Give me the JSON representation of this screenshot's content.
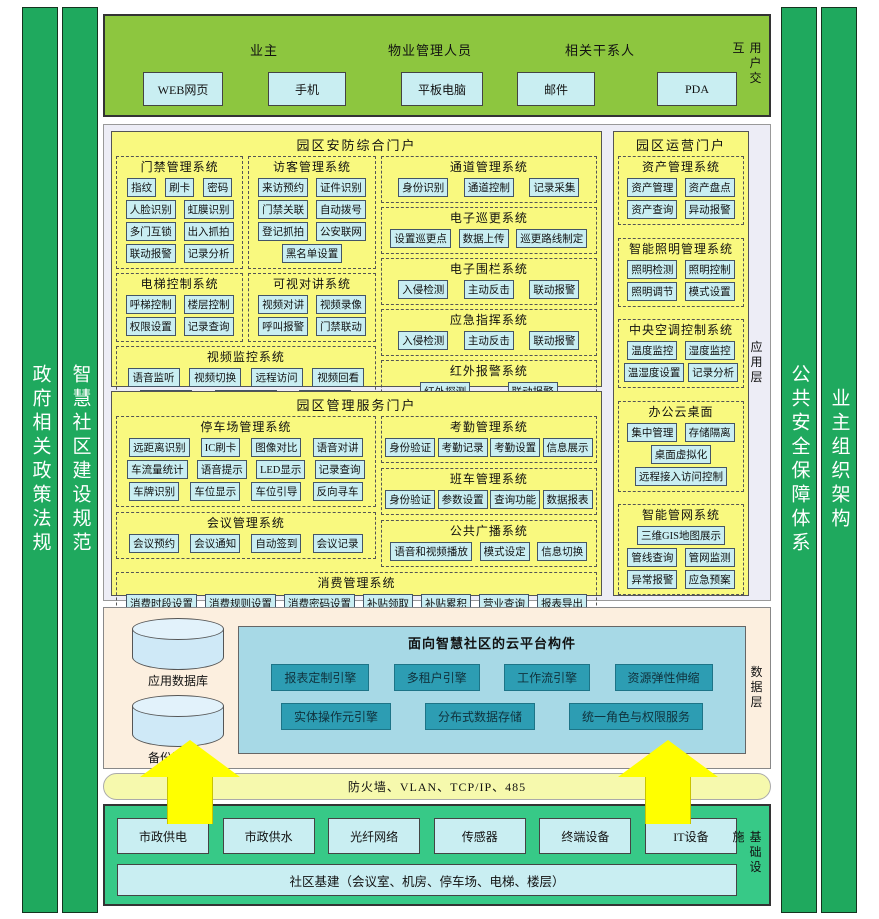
{
  "side_bars": {
    "left": [
      "政府相关政策法规",
      "智慧社区建设规范"
    ],
    "right": [
      "公共安全保障体系",
      "业主组织架构"
    ]
  },
  "user_layer": {
    "label": "用户交互",
    "groups": [
      "业主",
      "物业管理人员",
      "相关干系人"
    ],
    "devices": [
      "WEB网页",
      "手机",
      "平板电脑",
      "邮件",
      "PDA"
    ]
  },
  "application_layer": {
    "label": "应用层",
    "security_portal": {
      "title": "园区安防综合门户",
      "systems": [
        {
          "title": "门禁管理系统",
          "rows": [
            [
              "指纹",
              "刷卡",
              "密码"
            ],
            [
              "人脸识别",
              "虹膜识别"
            ],
            [
              "多门互锁",
              "出入抓拍"
            ],
            [
              "联动报警",
              "记录分析"
            ]
          ]
        },
        {
          "title": "访客管理系统",
          "rows": [
            [
              "来访预约",
              "证件识别"
            ],
            [
              "门禁关联",
              "自动拨号"
            ],
            [
              "登记抓拍",
              "公安联网"
            ],
            [
              "黑名单设置"
            ]
          ]
        },
        {
          "title": "电梯控制系统",
          "rows": [
            [
              "呼梯控制",
              "楼层控制"
            ],
            [
              "权限设置",
              "记录查询"
            ]
          ]
        },
        {
          "title": "可视对讲系统",
          "rows": [
            [
              "视频对讲",
              "视频录像"
            ],
            [
              "呼叫报警",
              "门禁联动"
            ]
          ]
        },
        {
          "title": "视频监控系统",
          "rows": [
            [
              "语音监听",
              "视频切换",
              "远程访问",
              "视频回看"
            ],
            [
              "本地录像",
              "电视墙显示",
              "联动报警"
            ]
          ]
        },
        {
          "title": "通道管理系统",
          "rows": [
            [
              "身份识别",
              "通道控制",
              "记录采集"
            ]
          ]
        },
        {
          "title": "电子巡更系统",
          "rows": [
            [
              "设置巡更点",
              "数据上传",
              "巡更路线制定"
            ]
          ]
        },
        {
          "title": "电子围栏系统",
          "rows": [
            [
              "入侵检测",
              "主动反击",
              "联动报警"
            ]
          ]
        },
        {
          "title": "应急指挥系统",
          "rows": [
            [
              "入侵检测",
              "主动反击",
              "联动报警"
            ]
          ]
        },
        {
          "title": "红外报警系统",
          "rows": [
            [
              "红外探测",
              "联动报警"
            ]
          ]
        }
      ]
    },
    "service_portal": {
      "title": "园区管理服务门户",
      "systems": [
        {
          "title": "停车场管理系统",
          "rows": [
            [
              "远距离识别",
              "IC刷卡",
              "图像对比",
              "语音对讲"
            ],
            [
              "车流量统计",
              "语音提示",
              "LED显示",
              "记录查询"
            ],
            [
              "车牌识别",
              "车位显示",
              "车位引导",
              "反向寻车"
            ]
          ]
        },
        {
          "title": "考勤管理系统",
          "rows": [
            [
              "身份验证",
              "考勤记录",
              "考勤设置",
              "信息展示"
            ]
          ]
        },
        {
          "title": "班车管理系统",
          "rows": [
            [
              "身份验证",
              "参数设置",
              "查询功能",
              "数据报表"
            ]
          ]
        },
        {
          "title": "会议管理系统",
          "rows": [
            [
              "会议预约",
              "会议通知",
              "自动签到",
              "会议记录"
            ]
          ]
        },
        {
          "title": "公共广播系统",
          "rows": [
            [
              "语音和视频播放",
              "模式设定",
              "信息切换"
            ]
          ]
        },
        {
          "title": "消费管理系统",
          "rows": [
            [
              "消费时段设置",
              "消费规则设置",
              "消费密码设置",
              "补贴领取",
              "补贴累积",
              "营业查询",
              "报表导出"
            ],
            [
              "卡发行",
              "卡注销",
              "卡充值",
              "卡挂失",
              "卡解挂",
              "卡权限修改",
              "黑名单设置"
            ]
          ]
        }
      ]
    },
    "operation_portal": {
      "title": "园区运营门户",
      "systems": [
        {
          "title": "资产管理系统",
          "rows": [
            [
              "资产管理",
              "资产盘点"
            ],
            [
              "资产查询",
              "异动报警"
            ]
          ]
        },
        {
          "title": "智能照明管理系统",
          "rows": [
            [
              "照明检测",
              "照明控制"
            ],
            [
              "照明调节",
              "模式设置"
            ]
          ]
        },
        {
          "title": "中央空调控制系统",
          "rows": [
            [
              "温度监控",
              "湿度监控"
            ],
            [
              "温湿度设置",
              "记录分析"
            ]
          ]
        },
        {
          "title": "办公云桌面",
          "rows": [
            [
              "集中管理",
              "存储隔离"
            ],
            [
              "桌面虚拟化"
            ],
            [
              "远程接入访问控制"
            ]
          ]
        },
        {
          "title": "智能管网系统",
          "rows": [
            [
              "三维GIS地图展示"
            ],
            [
              "管线查询",
              "管网监测"
            ],
            [
              "异常报警",
              "应急预案"
            ]
          ]
        }
      ]
    }
  },
  "data_layer": {
    "label": "数据层",
    "databases": [
      "应用数据库",
      "备份数据库"
    ],
    "cloud_platform": {
      "title": "面向智慧社区的云平台构件",
      "rows": [
        [
          "报表定制引擎",
          "多租户引擎",
          "工作流引擎",
          "资源弹性伸缩"
        ],
        [
          "实体操作元引擎",
          "分布式数据存储",
          "统一角色与权限服务"
        ]
      ]
    }
  },
  "network_bar": {
    "label": "防火墙、VLAN、TCP/IP、485"
  },
  "infrastructure_layer": {
    "label": "基础设施",
    "items": [
      "市政供电",
      "市政供水",
      "光纤网络",
      "传感器",
      "终端设备",
      "IT设备"
    ],
    "base": "社区基建（会议室、机房、停车场、电梯、楼层）"
  },
  "colors": {
    "sidebar-green": "#1fa95e",
    "user-green": "#8dc63f",
    "panel-yellow": "#f9f97f",
    "chip": "#c9eef2",
    "app-bg": "#ededf6",
    "data-bg": "#fcefdf",
    "cloud": "#a7d9e6",
    "cloud-btn": "#2d9db3",
    "firewall": "#f6f9ad",
    "infra": "#37c987",
    "arrow": "#ffff00"
  }
}
